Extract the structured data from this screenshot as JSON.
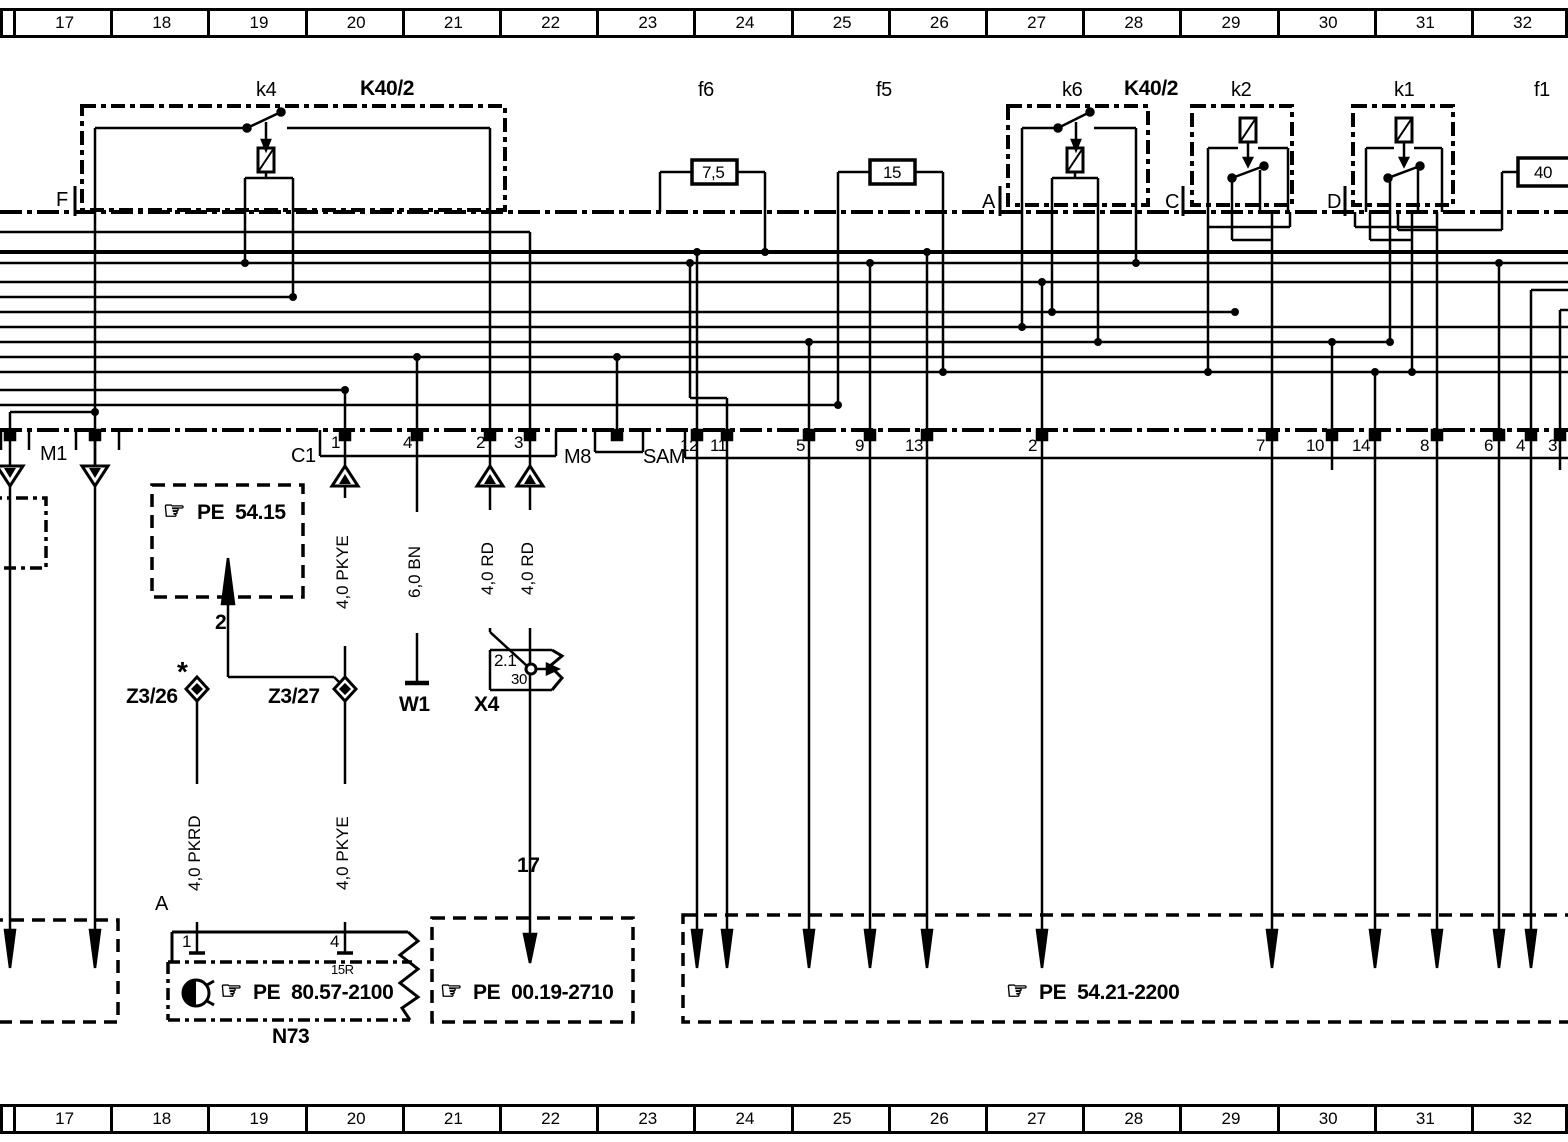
{
  "diagram_title": "SAM relay/fuse wiring schematic section",
  "colors": {
    "ink": "#000000",
    "paper": "#ffffff"
  },
  "ruler_top": [
    "17",
    "18",
    "19",
    "20",
    "21",
    "22",
    "23",
    "24",
    "25",
    "26",
    "27",
    "28",
    "29",
    "30",
    "31",
    "32"
  ],
  "ruler_bottom": [
    "17",
    "18",
    "19",
    "20",
    "21",
    "22",
    "23",
    "24",
    "25",
    "26",
    "27",
    "28",
    "29",
    "30",
    "31",
    "32"
  ],
  "sam_pins": [
    "12",
    "11",
    "5",
    "9",
    "13",
    "2",
    "7",
    "10",
    "14",
    "8",
    "6",
    "4",
    "3"
  ],
  "c1_pins": [
    "1",
    "4",
    "2",
    "3"
  ],
  "labels": [
    {
      "name": "relay-k4-label",
      "text": "k4",
      "x": 256,
      "y": 80,
      "cls": "lbl"
    },
    {
      "name": "module-k40-2-left-label",
      "text": "K40/2",
      "x": 360,
      "y": 78,
      "cls": "big"
    },
    {
      "name": "fuse-f6-label",
      "text": "f6",
      "x": 698,
      "y": 80,
      "cls": "lbl"
    },
    {
      "name": "fuse-f5-label",
      "text": "f5",
      "x": 876,
      "y": 80,
      "cls": "lbl"
    },
    {
      "name": "relay-k6-label",
      "text": "k6",
      "x": 1062,
      "y": 80,
      "cls": "lbl"
    },
    {
      "name": "module-k40-2-right-label",
      "text": "K40/2",
      "x": 1124,
      "y": 78,
      "cls": "big"
    },
    {
      "name": "relay-k2-label",
      "text": "k2",
      "x": 1231,
      "y": 80,
      "cls": "lbl"
    },
    {
      "name": "relay-k1-label",
      "text": "k1",
      "x": 1394,
      "y": 80,
      "cls": "lbl"
    },
    {
      "name": "fuse-f1-label",
      "text": "f1",
      "x": 1534,
      "y": 80,
      "cls": "lbl"
    },
    {
      "name": "fuse-f6-value",
      "text": "7,5",
      "x": 702,
      "y": 164,
      "cls": "pin"
    },
    {
      "name": "fuse-f5-value",
      "text": "15",
      "x": 883,
      "y": 164,
      "cls": "pin"
    },
    {
      "name": "fuse-f1-value",
      "text": "40",
      "x": 1534,
      "y": 164,
      "cls": "pin"
    },
    {
      "name": "section-f-label",
      "text": "F",
      "x": 56,
      "y": 190,
      "cls": "lbl"
    },
    {
      "name": "section-a-label",
      "text": "A",
      "x": 982,
      "y": 192,
      "cls": "lbl"
    },
    {
      "name": "section-c-label",
      "text": "C",
      "x": 1165,
      "y": 192,
      "cls": "lbl"
    },
    {
      "name": "section-d-label",
      "text": "D",
      "x": 1327,
      "y": 192,
      "cls": "lbl"
    },
    {
      "name": "connector-m1-label",
      "text": "M1",
      "x": 40,
      "y": 444,
      "cls": "lbl"
    },
    {
      "name": "connector-c1-label",
      "text": "C1",
      "x": 291,
      "y": 446,
      "cls": "lbl"
    },
    {
      "name": "c1-pin-1",
      "text": "1",
      "x": 331,
      "y": 434,
      "cls": "pin"
    },
    {
      "name": "c1-pin-4",
      "text": "4",
      "x": 403,
      "y": 434,
      "cls": "pin"
    },
    {
      "name": "c1-pin-2",
      "text": "2",
      "x": 476,
      "y": 434,
      "cls": "pin"
    },
    {
      "name": "c1-pin-3",
      "text": "3",
      "x": 514,
      "y": 434,
      "cls": "pin"
    },
    {
      "name": "connector-m8-label",
      "text": "M8",
      "x": 564,
      "y": 447,
      "cls": "lbl"
    },
    {
      "name": "module-sam-label",
      "text": "SAM",
      "x": 643,
      "y": 447,
      "cls": "lbl"
    },
    {
      "name": "sam-pin-12",
      "text": "12",
      "x": 680,
      "y": 437,
      "cls": "pin"
    },
    {
      "name": "sam-pin-11",
      "text": "11",
      "x": 710,
      "y": 437,
      "cls": "pin"
    },
    {
      "name": "sam-pin-5",
      "text": "5",
      "x": 796,
      "y": 437,
      "cls": "pin"
    },
    {
      "name": "sam-pin-9",
      "text": "9",
      "x": 855,
      "y": 437,
      "cls": "pin"
    },
    {
      "name": "sam-pin-13",
      "text": "13",
      "x": 905,
      "y": 437,
      "cls": "pin"
    },
    {
      "name": "sam-pin-2",
      "text": "2",
      "x": 1028,
      "y": 437,
      "cls": "pin"
    },
    {
      "name": "sam-pin-7",
      "text": "7",
      "x": 1256,
      "y": 437,
      "cls": "pin"
    },
    {
      "name": "sam-pin-10",
      "text": "10",
      "x": 1306,
      "y": 437,
      "cls": "pin"
    },
    {
      "name": "sam-pin-14",
      "text": "14",
      "x": 1352,
      "y": 437,
      "cls": "pin"
    },
    {
      "name": "sam-pin-8",
      "text": "8",
      "x": 1420,
      "y": 437,
      "cls": "pin"
    },
    {
      "name": "sam-pin-6",
      "text": "6",
      "x": 1484,
      "y": 437,
      "cls": "pin"
    },
    {
      "name": "sam-pin-4",
      "text": "4",
      "x": 1516,
      "y": 437,
      "cls": "pin"
    },
    {
      "name": "sam-pin-3",
      "text": "3",
      "x": 1548,
      "y": 437,
      "cls": "pin"
    },
    {
      "name": "ref-pe-54-15-hand",
      "text": "☞",
      "x": 163,
      "y": 499,
      "cls": "hand"
    },
    {
      "name": "ref-pe-54-15",
      "text": "PE  54.15",
      "x": 197,
      "y": 502,
      "cls": "big"
    },
    {
      "name": "branch-2-label",
      "text": "2",
      "x": 215,
      "y": 612,
      "cls": "big"
    },
    {
      "name": "z3-26-asterisk",
      "text": "*",
      "x": 177,
      "y": 658,
      "cls": "star"
    },
    {
      "name": "terminal-z3-26-label",
      "text": "Z3/26",
      "x": 126,
      "y": 686,
      "cls": "big"
    },
    {
      "name": "terminal-z3-27-label",
      "text": "Z3/27",
      "x": 268,
      "y": 686,
      "cls": "big"
    },
    {
      "name": "component-w1-label",
      "text": "W1",
      "x": 399,
      "y": 694,
      "cls": "big"
    },
    {
      "name": "component-x4-label",
      "text": "X4",
      "x": 474,
      "y": 694,
      "cls": "big"
    },
    {
      "name": "x4-code",
      "text": "2.1",
      "x": 494,
      "y": 652,
      "cls": "pin"
    },
    {
      "name": "x4-terminal-30",
      "text": "30",
      "x": 511,
      "y": 672,
      "cls": "sm"
    },
    {
      "name": "wire-17-label",
      "text": "17",
      "x": 517,
      "y": 855,
      "cls": "big"
    },
    {
      "name": "n73-section-a-label",
      "text": "A",
      "x": 155,
      "y": 894,
      "cls": "lbl"
    },
    {
      "name": "n73-pin-1",
      "text": "1",
      "x": 182,
      "y": 933,
      "cls": "pin"
    },
    {
      "name": "n73-pin-4",
      "text": "4",
      "x": 330,
      "y": 933,
      "cls": "pin"
    },
    {
      "name": "n73-terminal-15r",
      "text": "15R",
      "x": 331,
      "y": 963,
      "cls": "xs"
    },
    {
      "name": "ref-pe-80-57-2100-hand",
      "text": "☞",
      "x": 220,
      "y": 979,
      "cls": "hand"
    },
    {
      "name": "ref-pe-80-57-2100",
      "text": "PE  80.57-2100",
      "x": 253,
      "y": 982,
      "cls": "big"
    },
    {
      "name": "component-n73-label",
      "text": "N73",
      "x": 272,
      "y": 1026,
      "cls": "big"
    },
    {
      "name": "ref-pe-00-19-2710-hand",
      "text": "☞",
      "x": 440,
      "y": 979,
      "cls": "hand"
    },
    {
      "name": "ref-pe-00-19-2710",
      "text": "PE  00.19-2710",
      "x": 473,
      "y": 982,
      "cls": "big"
    },
    {
      "name": "ref-pe-54-21-2200-hand",
      "text": "☞",
      "x": 1006,
      "y": 979,
      "cls": "hand"
    },
    {
      "name": "ref-pe-54-21-2200",
      "text": "PE  54.21-2200",
      "x": 1039,
      "y": 982,
      "cls": "big"
    }
  ],
  "vertical_wire_labels": [
    {
      "name": "wire-label-pkye-upper",
      "text": "4,0 PKYE",
      "x": 345,
      "y": 498,
      "h": 142
    },
    {
      "name": "wire-label-bn",
      "text": "6,0 BN",
      "x": 417,
      "y": 512,
      "h": 115
    },
    {
      "name": "wire-label-rd-left",
      "text": "4,0 RD",
      "x": 490,
      "y": 510,
      "h": 112
    },
    {
      "name": "wire-label-rd-right",
      "text": "4,0 RD",
      "x": 530,
      "y": 510,
      "h": 112
    },
    {
      "name": "wire-label-pkrd",
      "text": "4,0 PKRD",
      "x": 197,
      "y": 784,
      "h": 132
    },
    {
      "name": "wire-label-pkye-lower",
      "text": "4,0 PKYE",
      "x": 345,
      "y": 784,
      "h": 132
    }
  ]
}
